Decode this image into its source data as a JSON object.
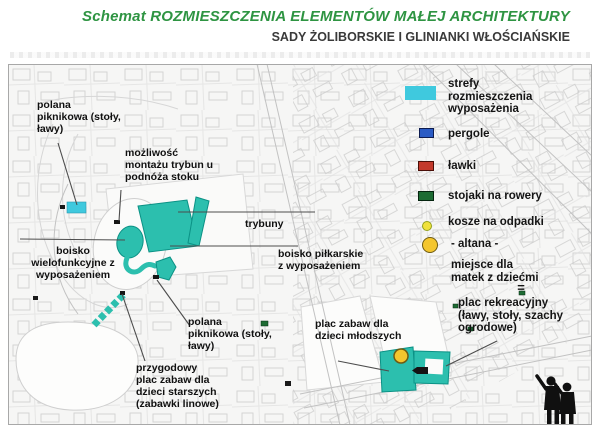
{
  "header": {
    "title": "Schemat ROZMIESZCZENIA ELEMENTÓW MAŁEJ ARCHITEKTURY",
    "subtitle": "SADY ŻOLIBORSKIE  I GLINIANKI WŁOŚCIAŃSKIE"
  },
  "colors": {
    "title_green": "#2E9442",
    "subtitle_gray": "#3A3A3A",
    "zone_cyan": "#3FC9DE",
    "equipment_teal": "#2CBFAE",
    "teal_stroke": "#0B9185",
    "pergola_blue": "#2A5BC4",
    "bench_red": "#C33A2C",
    "bike_green": "#1D6B33",
    "bin_yellow": "#F0E13C",
    "gazebo_yellow": "#F4C62E"
  },
  "legend": {
    "zone": "strefy\nrozmieszczenia\nwyposażenia",
    "pergole": "pergole",
    "lawki": "ławki",
    "stojaki": "stojaki na rowery",
    "kosze": "kosze na odpadki",
    "altana": "- altana -",
    "miejsce": "miejsce dla\nmatek z dziećmi",
    "equals": "=",
    "plac_rekreacyjny": "plac rekreacyjny\n(ławy, stoły, szachy\nogrodowe)"
  },
  "map_labels": {
    "polana_nw": "polana\npiknikowa (stoły,\nławy)",
    "mozliwosc_trybun": "możliwość\nmontażu trybun u\npodnóża stoku",
    "trybuny": "trybuny",
    "boisko_pilkarskie": "boisko piłkarskie\nz wyposażeniem",
    "boisko_wielofunkcyjne": "boisko\nwielofunkcyjne z\nwyposażeniem",
    "polana_s": "polana\npiknikowa (stoły,\nławy)",
    "przygodowy": "przygodowy\nplac zabaw dla\ndzieci starszych\n(zabawki linowe)",
    "plac_mlodszych": "plac zabaw dla\ndzieci młodszych"
  }
}
